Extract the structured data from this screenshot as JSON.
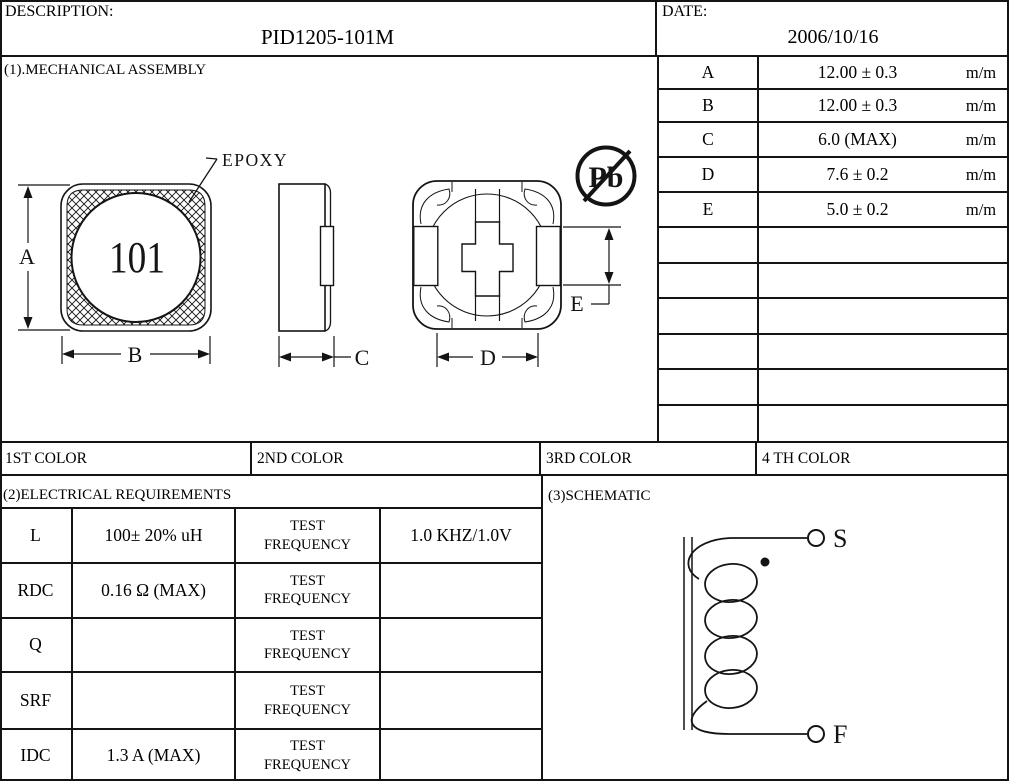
{
  "header": {
    "description_label": "DESCRIPTION:",
    "part_number": "PID1205-101M",
    "date_label": "DATE:",
    "date_value": "2006/10/16"
  },
  "mechanical": {
    "title": "(1).MECHANICAL ASSEMBLY",
    "drawing": {
      "epoxy_label": "EPOXY",
      "marking": "101",
      "pb_free_label": "Pb",
      "dim_a": "A",
      "dim_b": "B",
      "dim_c": "C",
      "dim_d": "D",
      "dim_e": "E"
    },
    "dimension_table": {
      "rows": [
        {
          "key": "A",
          "value": "12.00 ± 0.3",
          "unit": "m/m"
        },
        {
          "key": "B",
          "value": "12.00 ± 0.3",
          "unit": "m/m"
        },
        {
          "key": "C",
          "value": "6.0 (MAX)",
          "unit": "m/m"
        },
        {
          "key": "D",
          "value": "7.6 ± 0.2",
          "unit": "m/m"
        },
        {
          "key": "E",
          "value": "5.0 ± 0.2",
          "unit": "m/m"
        },
        {
          "key": "",
          "value": "",
          "unit": ""
        },
        {
          "key": "",
          "value": "",
          "unit": ""
        },
        {
          "key": "",
          "value": "",
          "unit": ""
        },
        {
          "key": "",
          "value": "",
          "unit": ""
        },
        {
          "key": "",
          "value": "",
          "unit": ""
        },
        {
          "key": "",
          "value": "",
          "unit": ""
        }
      ]
    }
  },
  "color_row": {
    "first": "1ST COLOR",
    "second": "2ND COLOR",
    "third": "3RD COLOR",
    "fourth": "4 TH COLOR"
  },
  "electrical": {
    "title": "(2)ELECTRICAL REQUIREMENTS",
    "rows": [
      {
        "param": "L",
        "value": "100± 20% uH",
        "test": "TEST FREQUENCY",
        "condition": "1.0 KHZ/1.0V"
      },
      {
        "param": "RDC",
        "value": "0.16 Ω (MAX)",
        "test": "TEST FREQUENCY",
        "condition": ""
      },
      {
        "param": "Q",
        "value": "",
        "test": "TEST FREQUENCY",
        "condition": ""
      },
      {
        "param": "SRF",
        "value": "",
        "test": "TEST FREQUENCY",
        "condition": ""
      },
      {
        "param": "IDC",
        "value": "1.3 A (MAX)",
        "test": "TEST FREQUENCY",
        "condition": ""
      }
    ]
  },
  "schematic": {
    "title": "(3)SCHEMATIC",
    "start_terminal": "S",
    "finish_terminal": "F"
  }
}
